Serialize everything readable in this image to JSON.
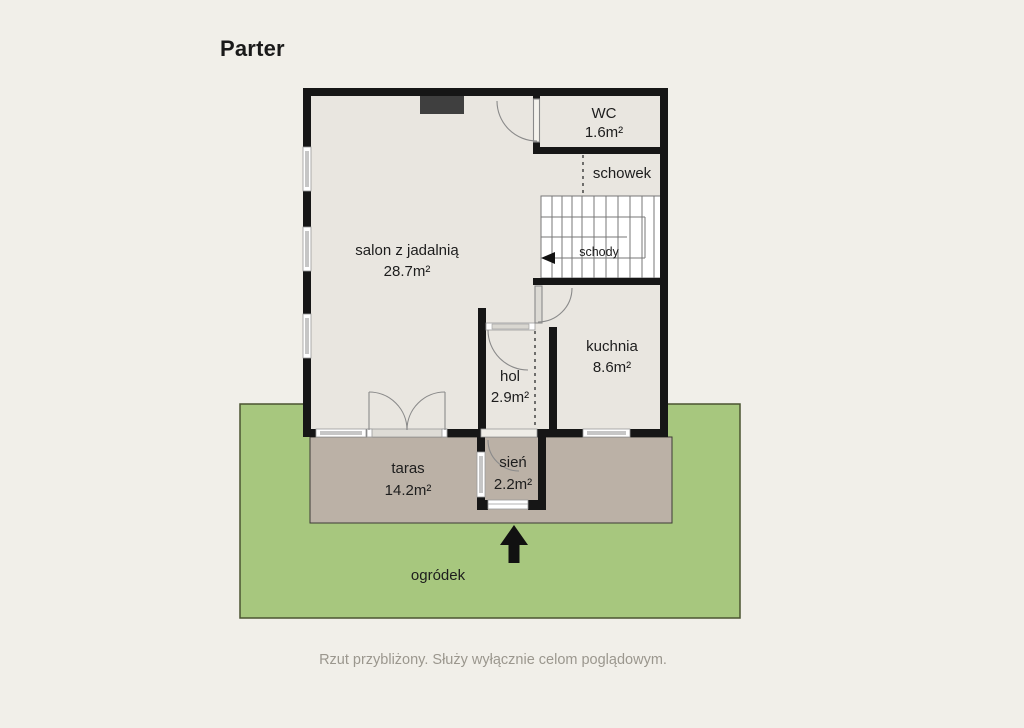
{
  "floor": {
    "title": "Parter",
    "disclaimer": "Rzut przybliżony. Służy wyłącznie celom poglądowym."
  },
  "rooms": {
    "salon": {
      "name": "salon z jadalnią",
      "area": "28.7m²"
    },
    "wc": {
      "name": "WC",
      "area": "1.6m²"
    },
    "schowek": {
      "name": "schowek"
    },
    "schody": {
      "name": "schody"
    },
    "kuchnia": {
      "name": "kuchnia",
      "area": "8.6m²"
    },
    "hol": {
      "name": "hol",
      "area": "2.9m²"
    },
    "sien": {
      "name": "sień",
      "area": "2.2m²"
    },
    "taras": {
      "name": "taras",
      "area": "14.2m²"
    },
    "ogrodek": {
      "name": "ogródek"
    }
  },
  "colors": {
    "background": "#f1efe9",
    "floor": "#e9e6e0",
    "wall": "#161616",
    "garden": "#a7c77e",
    "garden_border": "#4a5430",
    "terrace": "#bbb1a6",
    "window_glass": "#c6c6c6",
    "stairs_background": "#ffffff",
    "label_text": "#1d1d1d",
    "caption_text": "#9b978e",
    "niche": "#3f3f3f"
  }
}
